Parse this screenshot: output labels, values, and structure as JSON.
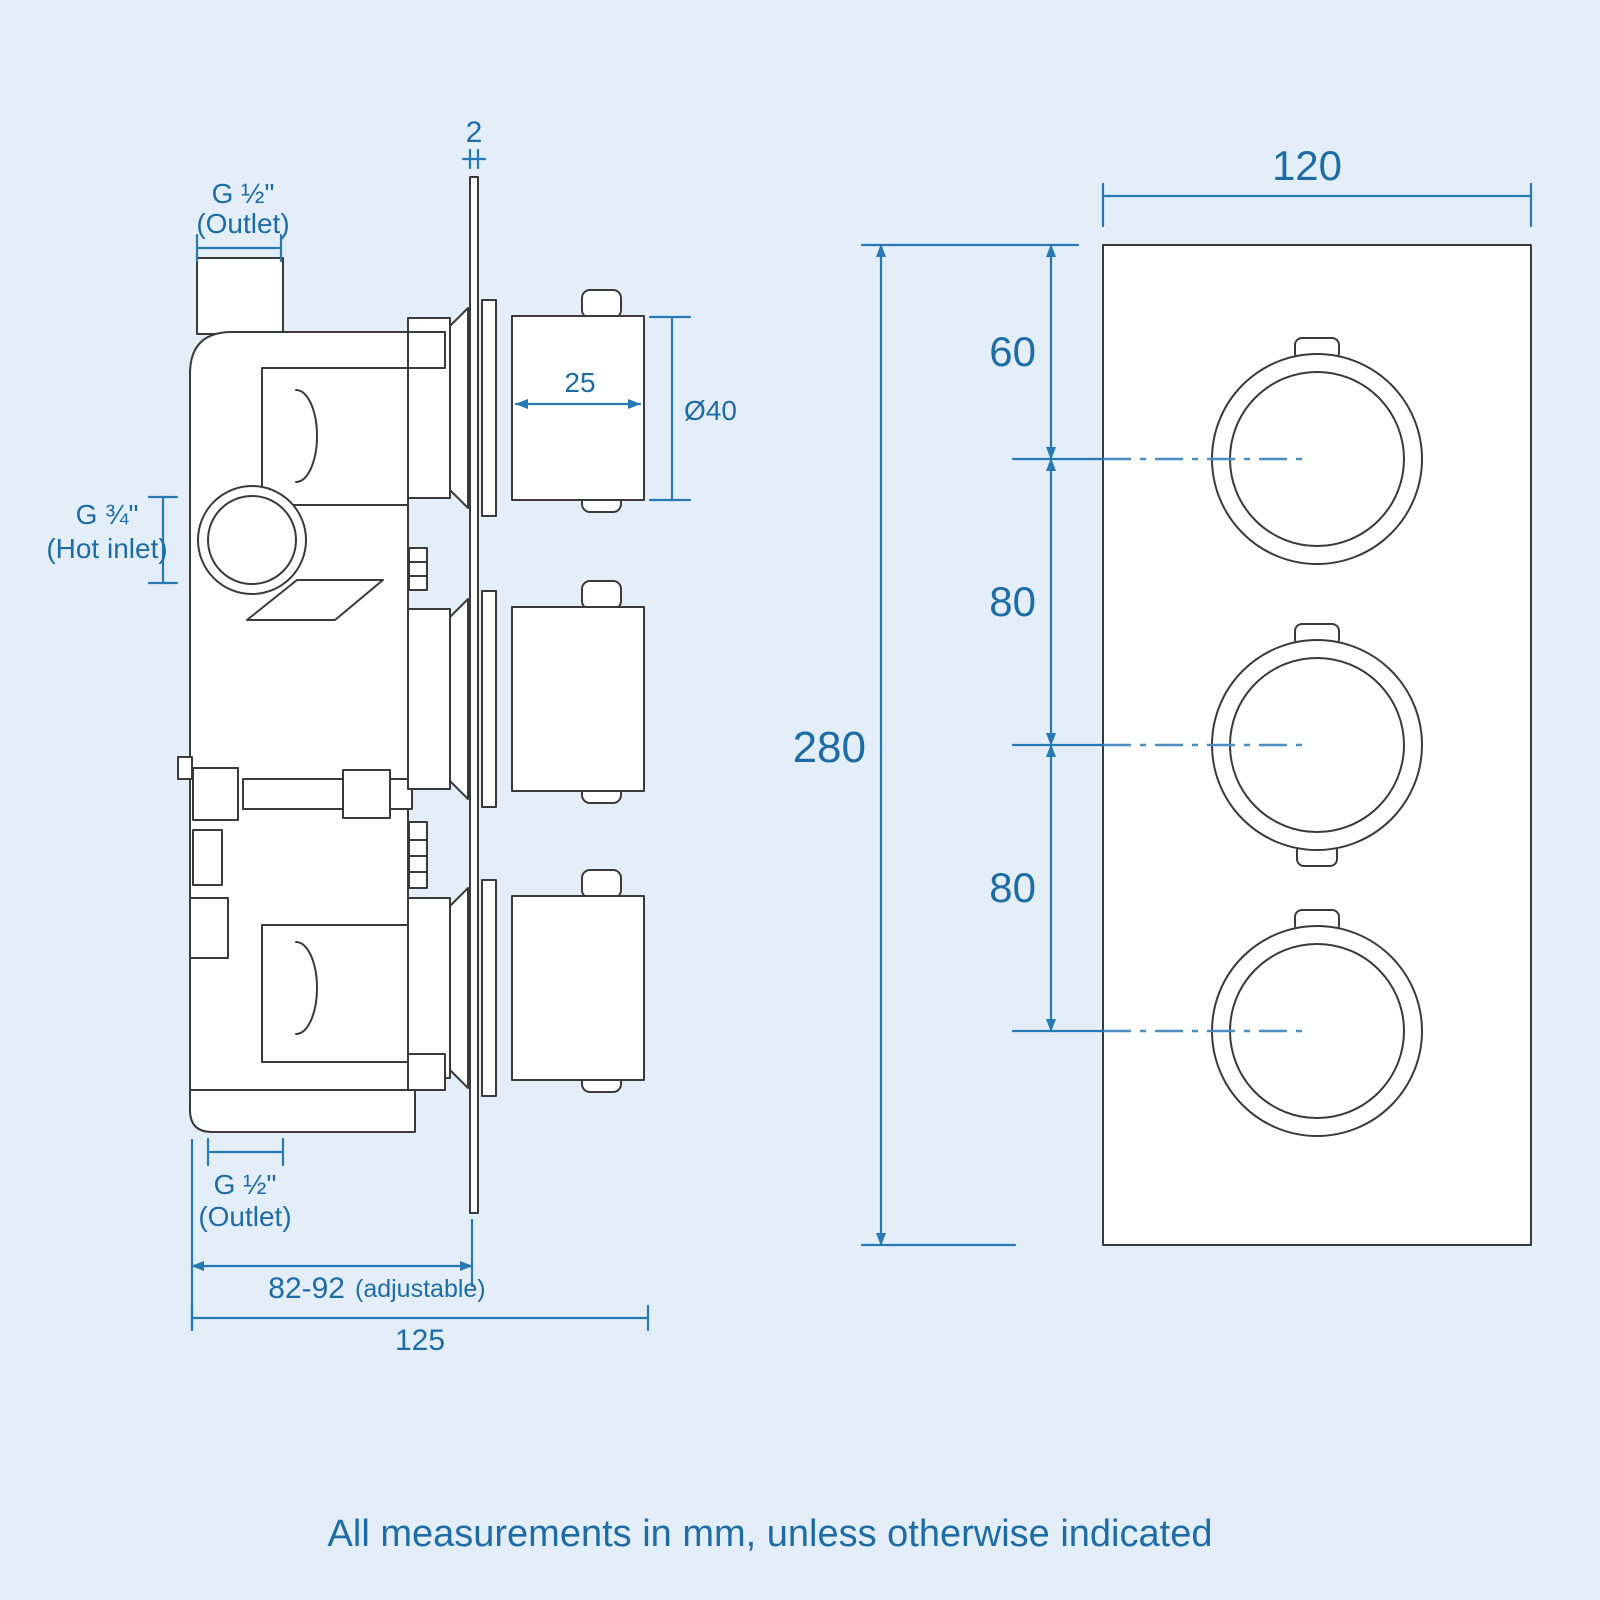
{
  "colors": {
    "background": "#e3eef9",
    "drawing_line": "#3a3a3a",
    "dimension_blue": "#2679b2",
    "text_blue": "#1e6ca6"
  },
  "side_view": {
    "plate_thickness": "2",
    "top_outlet": {
      "line1": "G ½\"",
      "line2": "(Outlet)"
    },
    "hot_inlet": {
      "line1": "G ¾\"",
      "line2": "(Hot inlet)"
    },
    "knob_depth": "25",
    "knob_diameter": "Ø40",
    "bottom_outlet": {
      "line1": "G ½\"",
      "line2": "(Outlet)"
    },
    "adjustable_range": "82-92",
    "adjustable_note": "(adjustable)",
    "overall_depth": "125"
  },
  "front_view": {
    "width": "120",
    "height": "280",
    "top_to_first": "60",
    "first_to_second": "80",
    "second_to_third": "80"
  },
  "footer": {
    "note": "All measurements in mm, unless otherwise indicated"
  }
}
